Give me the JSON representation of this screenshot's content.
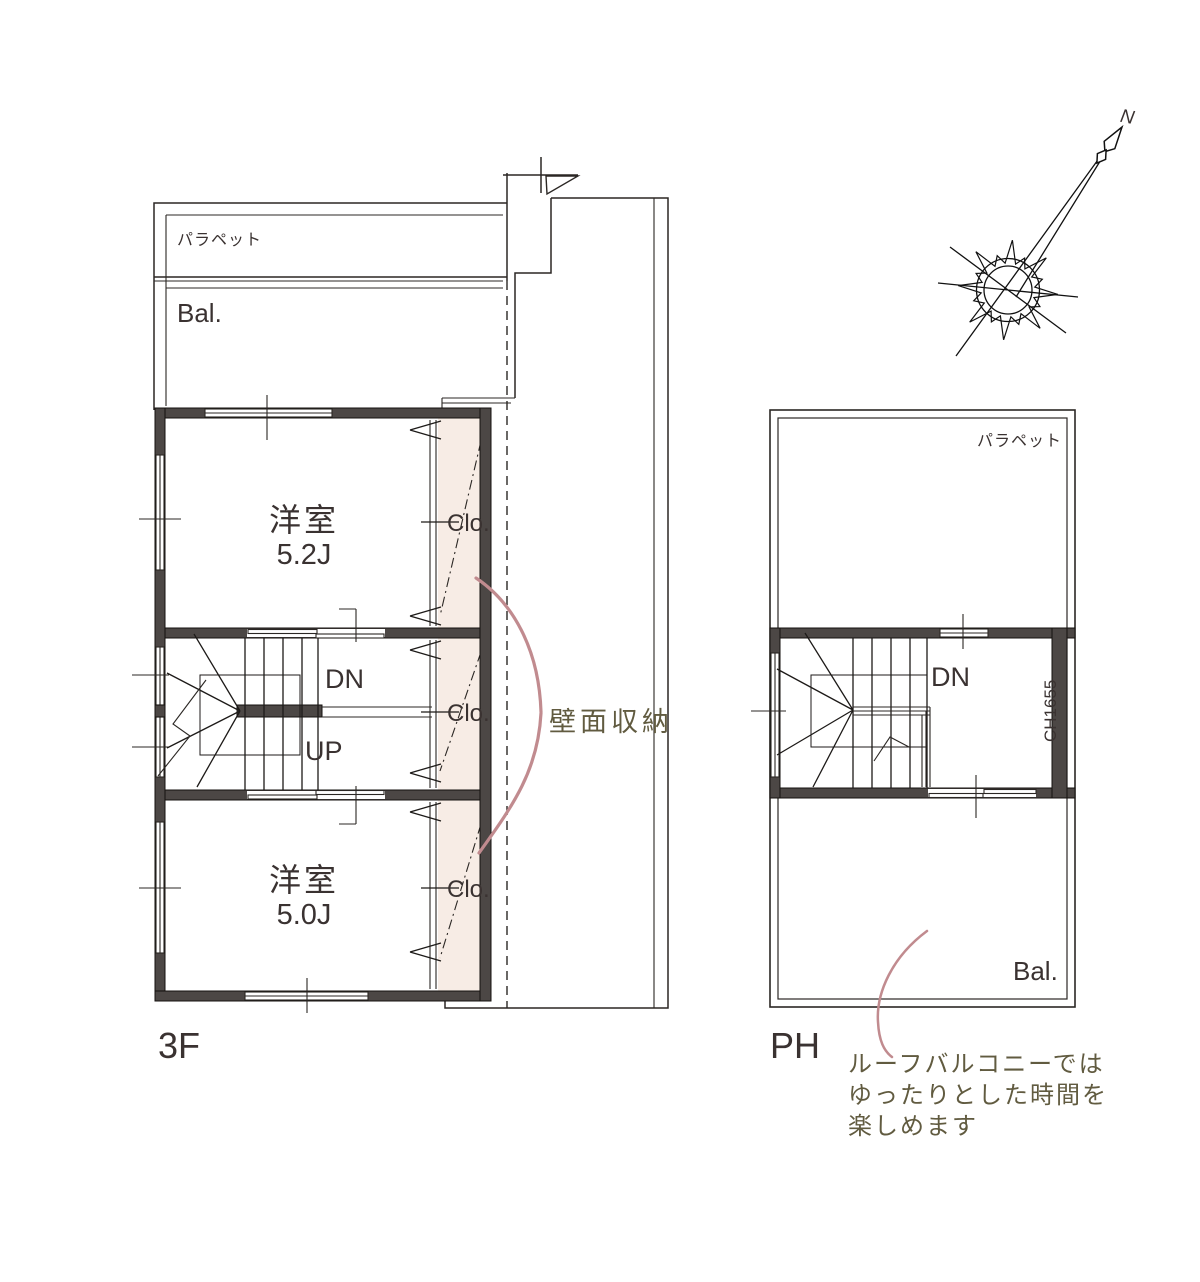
{
  "colors": {
    "wall_fill": "#4c4745",
    "closet_fill": "#f7ece5",
    "annotation_pink": "#c18b8f",
    "handwriting_olive": "#615b40",
    "label_dark": "#3a3231"
  },
  "compass": {
    "north_label": "N"
  },
  "plan_3f": {
    "floor_label": "3F",
    "parapet_label": "パラペット",
    "balcony_label": "Bal.",
    "room_upper": {
      "name": "洋室",
      "size": "5.2J"
    },
    "room_lower": {
      "name": "洋室",
      "size": "5.0J"
    },
    "closets": {
      "upper": "Clo.",
      "middle": "Clo.",
      "lower": "Clo."
    },
    "stair": {
      "down": "DN",
      "up": "UP"
    },
    "wall_storage_note": "壁面収納"
  },
  "plan_ph": {
    "floor_label": "PH",
    "parapet_label": "パラペット",
    "balcony_label": "Bal.",
    "stair": {
      "down": "DN"
    },
    "ceiling_height": "CH1655",
    "roof_balcony_note": [
      "ルーフバルコニーでは",
      "ゆったりとした時間を",
      "楽しめます"
    ]
  }
}
